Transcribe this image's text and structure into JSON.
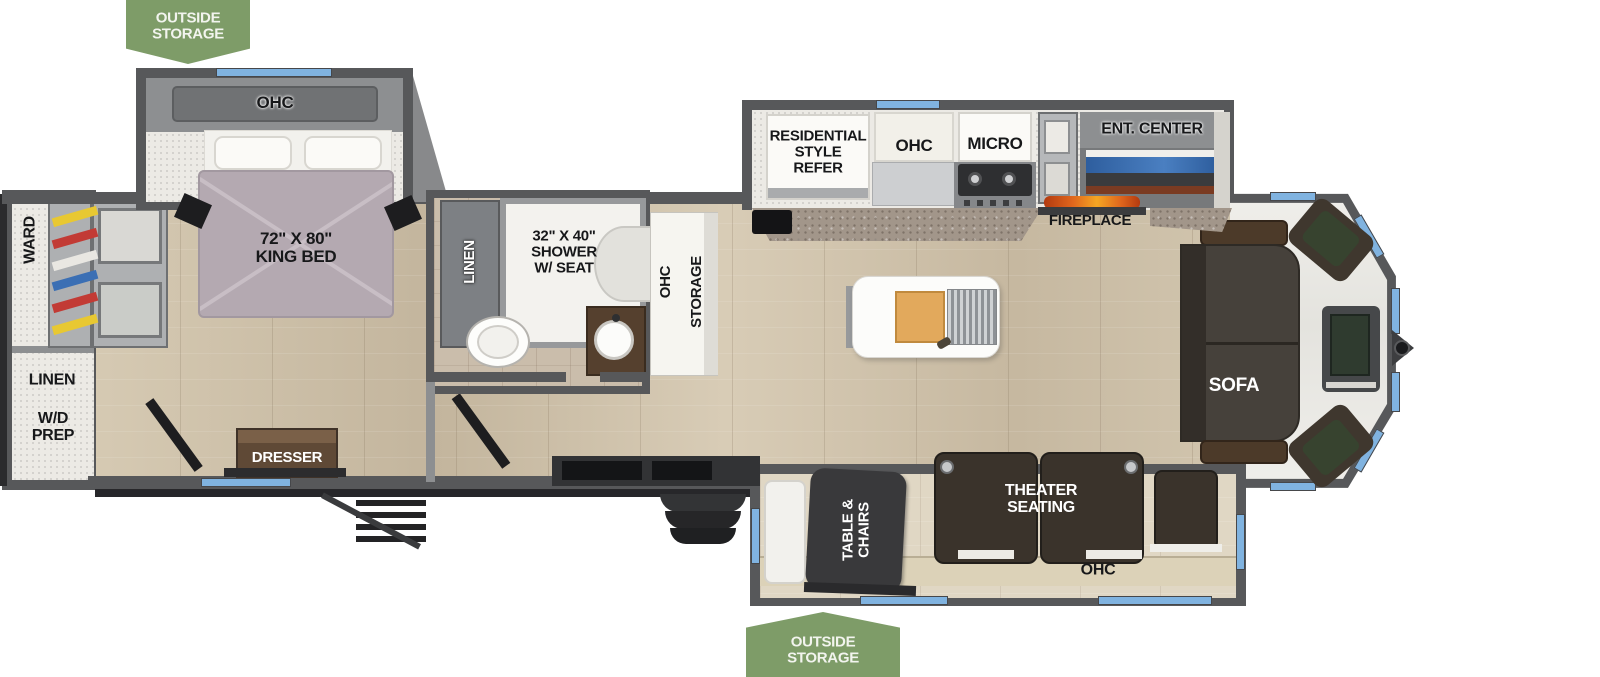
{
  "plan": {
    "outside_storage_top": "OUTSIDE\nSTORAGE",
    "outside_storage_bottom": "OUTSIDE\nSTORAGE"
  },
  "rear": {
    "ward": "WARD",
    "linen": "LINEN",
    "wd_prep": "W/D\nPREP"
  },
  "bedroom": {
    "ohc": "OHC",
    "king_bed": "72\" X 80\"\nKING BED",
    "dresser": "DRESSER"
  },
  "bathroom": {
    "linen": "LINEN",
    "shower": "32\" X 40\"\nSHOWER\nW/ SEAT"
  },
  "hallway": {
    "ohc": "OHC",
    "storage": "STORAGE"
  },
  "kitchen": {
    "refer": "RESIDENTIAL\nSTYLE\nREFER",
    "ohc": "OHC",
    "micro": "MICRO"
  },
  "living": {
    "ent_center": "ENT. CENTER",
    "fireplace": "FIREPLACE",
    "sofa": "SOFA"
  },
  "dinette": {
    "table_chairs": "TABLE &\nCHAIRS",
    "theater": "THEATER\nSEATING",
    "ohc": "OHC"
  },
  "colors": {
    "tag_green": "#7e9c68",
    "window_blue": "#80b3e0",
    "wall_gray": "#57585a",
    "floor_wood": "#ccc0aa",
    "sofa_brown": "#46413b",
    "bed_mauve": "#b4a9b1",
    "flame_orange": "#e0661d"
  }
}
